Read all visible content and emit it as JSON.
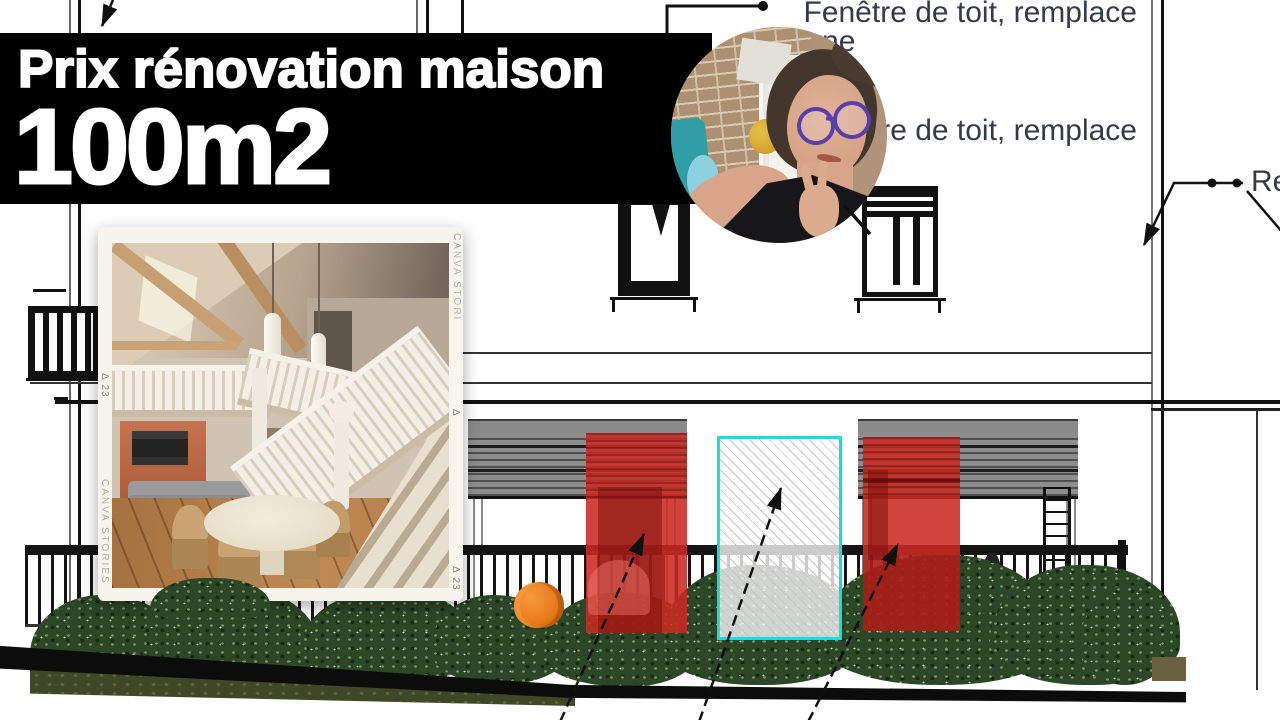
{
  "banner": {
    "title": "Prix rénovation maison",
    "subtitle": "100m2",
    "bg_color": "#000000",
    "text_color": "#ffffff"
  },
  "annotations": {
    "roof_window_1": "Fenêtre de toit, remplace",
    "roof_window_1_line2": "lucarne",
    "roof_window_2": "Fenêtre de toit, remplace",
    "right_label": "Remplace",
    "text_color": "#343b46"
  },
  "polaroid": {
    "watermark_left": "CANVA STORIES",
    "watermark_right": "CANVA STORI",
    "register_mark_symbol": "Δ",
    "register_mark_number": "23"
  },
  "colors": {
    "highlight_red": "#c92a22",
    "highlight_cyan": "#12e0e0",
    "shutter_gray": "#8a8a8a",
    "hedge_green": "#2c4727",
    "ground_black": "#0c0c0c",
    "grass_olive": "#3e4726",
    "accent_orange": "#e87b1e",
    "drawing_line": "#111111"
  }
}
